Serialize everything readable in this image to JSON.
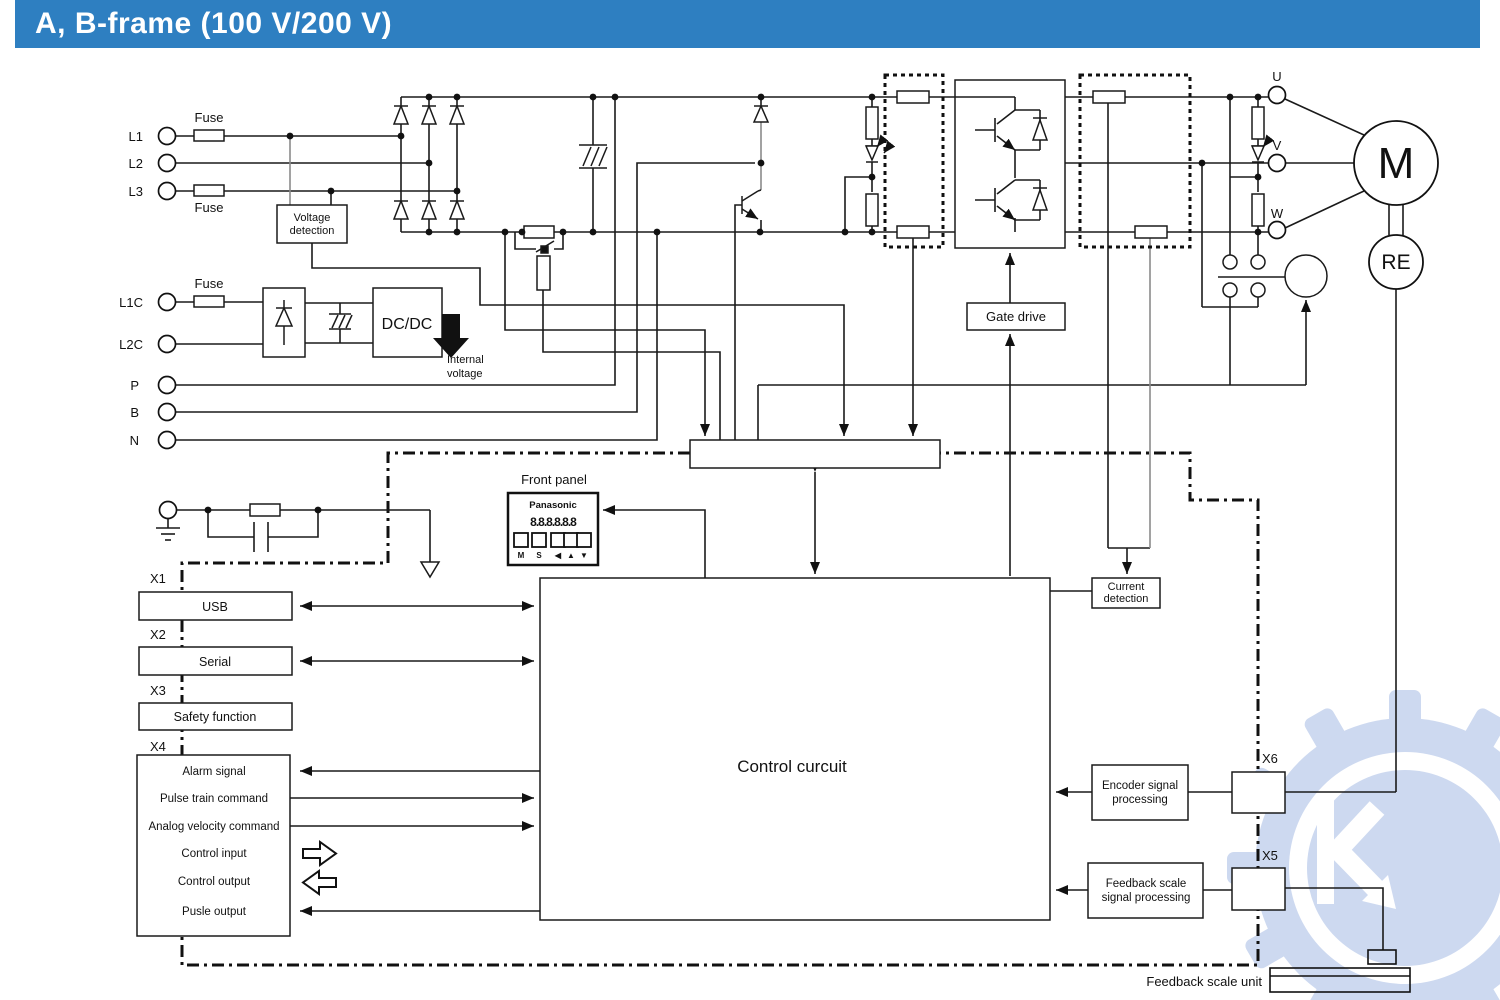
{
  "header": {
    "title": "A, B-frame (100 V/200 V)"
  },
  "terminals": {
    "l1": "L1",
    "l2": "L2",
    "l3": "L3",
    "l1c": "L1C",
    "l2c": "L2C",
    "p": "P",
    "b": "B",
    "n": "N",
    "u": "U",
    "v": "V",
    "w": "W"
  },
  "fuses": {
    "top": "Fuse",
    "bottom": "Fuse",
    "control": "Fuse"
  },
  "blocks": {
    "voltage_detection": {
      "line1": "Voltage",
      "line2": "detection"
    },
    "dcdc": {
      "label": "DC/DC"
    },
    "internal_voltage": {
      "line1": "Internal",
      "line2": "voltage"
    },
    "gate_drive": {
      "label": "Gate drive"
    },
    "current_detection": {
      "line1": "Current",
      "line2": "detection"
    },
    "control_circuit": {
      "label": "Control curcuit"
    },
    "encoder": {
      "line1": "Encoder signal",
      "line2": "processing"
    },
    "feedback": {
      "line1": "Feedback scale",
      "line2": "signal processing"
    },
    "feedback_unit": {
      "label": "Feedback scale unit"
    }
  },
  "front_panel": {
    "caption": "Front panel",
    "brand": "Panasonic",
    "display": "8.8.8.8.8.8",
    "buttons": [
      "M",
      "S",
      "◀",
      "▲",
      "▼"
    ]
  },
  "connectors": {
    "x1": "X1",
    "x2": "X2",
    "x3": "X3",
    "x4": "X4",
    "x5": "X5",
    "x6": "X6"
  },
  "io": {
    "usb": "USB",
    "serial": "Serial",
    "safety": "Safety function",
    "x4_rows": [
      "Alarm signal",
      "Pulse train command",
      "Analog velocity command",
      "Control input",
      "Control output",
      "Pusle output"
    ]
  },
  "motor": {
    "m": "M",
    "re": "RE"
  },
  "colors": {
    "header_bg": "#2e7fc1",
    "line": "#1a1a1a",
    "watermark": "#cdd9f0"
  }
}
